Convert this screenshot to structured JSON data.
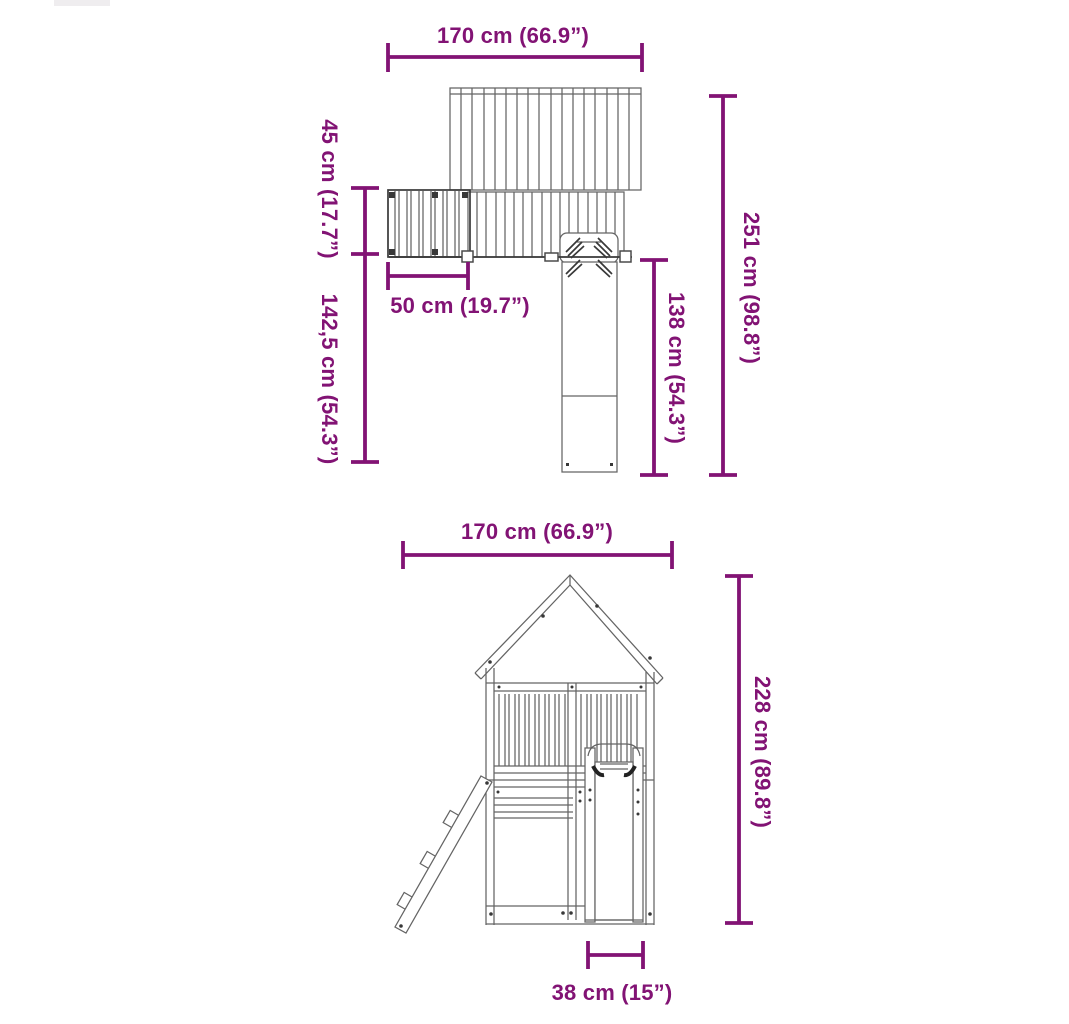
{
  "colors": {
    "dimension_accent": "#821374",
    "drawing_line": "#646464",
    "drawing_dark": "#383838",
    "background": "#FFFFFF"
  },
  "top_view": {
    "width_label": "170 cm (66.9”)",
    "ladder_depth_label": "45 cm (17.7”)",
    "depth_below_platform_label": "142,5 cm (54.3”)",
    "ladder_width_label": "50 cm (19.7”)",
    "total_depth_label": "251 cm (98.8”)",
    "slide_length_label": "138 cm (54.3”)"
  },
  "front_view": {
    "width_label": "170 cm (66.9”)",
    "height_label": "228 cm (89.8”)",
    "slide_width_label": "38 cm (15”)"
  }
}
